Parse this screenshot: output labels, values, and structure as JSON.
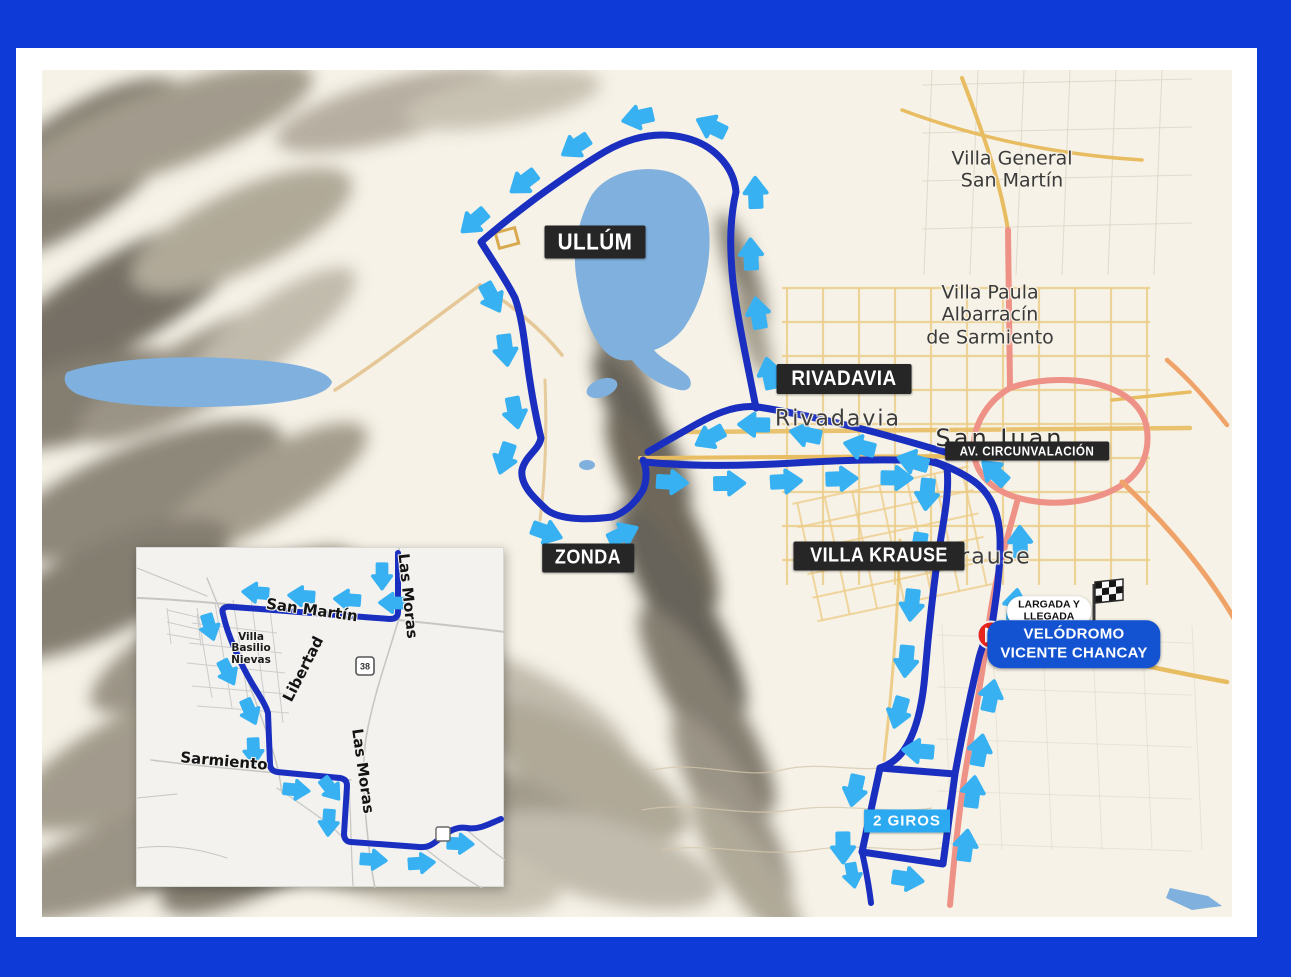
{
  "badges": {
    "ullum": "ULLÚM",
    "zonda": "ZONDA",
    "rivadavia": "RIVADAVIA",
    "villa_krause": "VILLA KRAUSE",
    "av_circunvalacion": "AV. CIRCUNVALACIÓN"
  },
  "places": {
    "villa_general_1": "Villa General",
    "villa_general_2": "San Martín",
    "villa_paula_1": "Villa Paula",
    "villa_paula_2": "Albarracín",
    "villa_paula_3": "de Sarmiento",
    "san_juan": "San Juan",
    "rivadavia": "Rivadavia",
    "villa_krause": "Villa Krause"
  },
  "finish": {
    "largada_1": "LARGADA Y",
    "largada_2": "LLEGADA",
    "velodromo_1": "VELÓDROMO",
    "velodromo_2": "VICENTE CHANCAY",
    "giros": "2 GIROS"
  },
  "inset": {
    "streets": {
      "san_martin": "San Martín",
      "las_moras_top": "Las Moras",
      "las_moras_bottom": "Las Moras",
      "libertad": "Libertad",
      "sarmiento": "Sarmiento"
    },
    "town_1": "Villa",
    "town_2": "Basilio",
    "town_3": "Nievas",
    "shield": "38"
  },
  "colors": {
    "frame": "#0e3ad8",
    "route": "#1a2fc0",
    "arrow": "#38b1f2",
    "water": "#7fb0de",
    "velodromo_bg": "#1352d1",
    "giros_bg": "#2ba9f1",
    "start_marker": "#e6251c"
  }
}
